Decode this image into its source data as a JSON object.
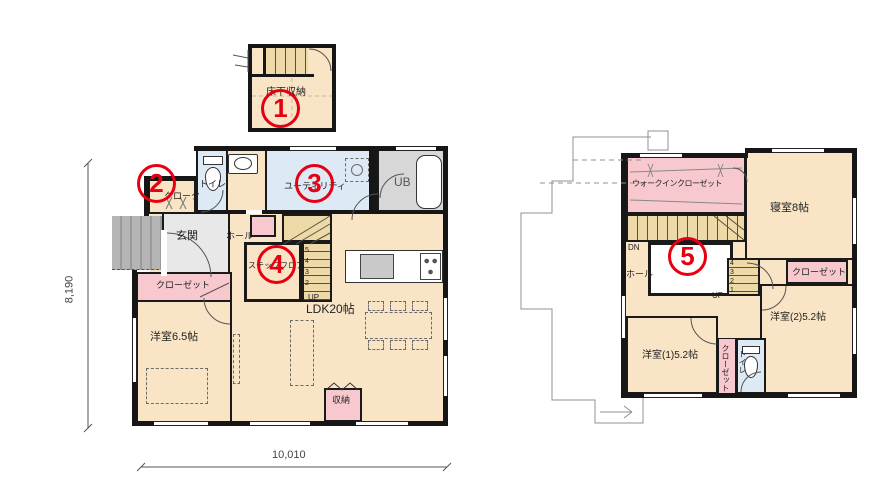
{
  "colors": {
    "floor_cream": "#f9e4c5",
    "closet_pink": "#f7c9ce",
    "wet_blue": "#dde9f5",
    "bath_gray": "#d7d7d7",
    "entry_gray": "#e8e8e8",
    "porch_gray": "#b5b5b5",
    "stair_tan": "#eddaa8",
    "wall_black": "#161616",
    "marker_red": "#e60012"
  },
  "dimensions": {
    "height": "8,190",
    "width": "10,010"
  },
  "markers": {
    "m1": "1",
    "m2": "2",
    "m3": "3",
    "m4": "4",
    "m5": "5"
  },
  "underfloor": {
    "label": "床下収納"
  },
  "floor1": {
    "cloak": "クローク",
    "toilet": "トイレ",
    "entrance": "玄関",
    "hall": "ホール",
    "utility": "ユーティリティ",
    "unit_bath": "UB",
    "step_floor": "ステップフロア",
    "closet": "クローゼット",
    "western_room": "洋室6.5帖",
    "ldk": "LDK20帖",
    "storage": "収納",
    "up": "UP",
    "stair_digits": [
      "5",
      "4",
      "3",
      "2"
    ]
  },
  "floor2": {
    "wic": "ウォークインクローゼット",
    "bedroom": "寝室8帖",
    "dn": "DN",
    "hall": "ホール",
    "up": "UP",
    "attic_digits": [
      "4",
      "3",
      "2",
      "1"
    ],
    "closet_a": "クローゼット",
    "room2": "洋室(2)5.2帖",
    "room1": "洋室(1)5.2帖",
    "closet_b": "クローゼット",
    "toilet": "トイレ"
  }
}
